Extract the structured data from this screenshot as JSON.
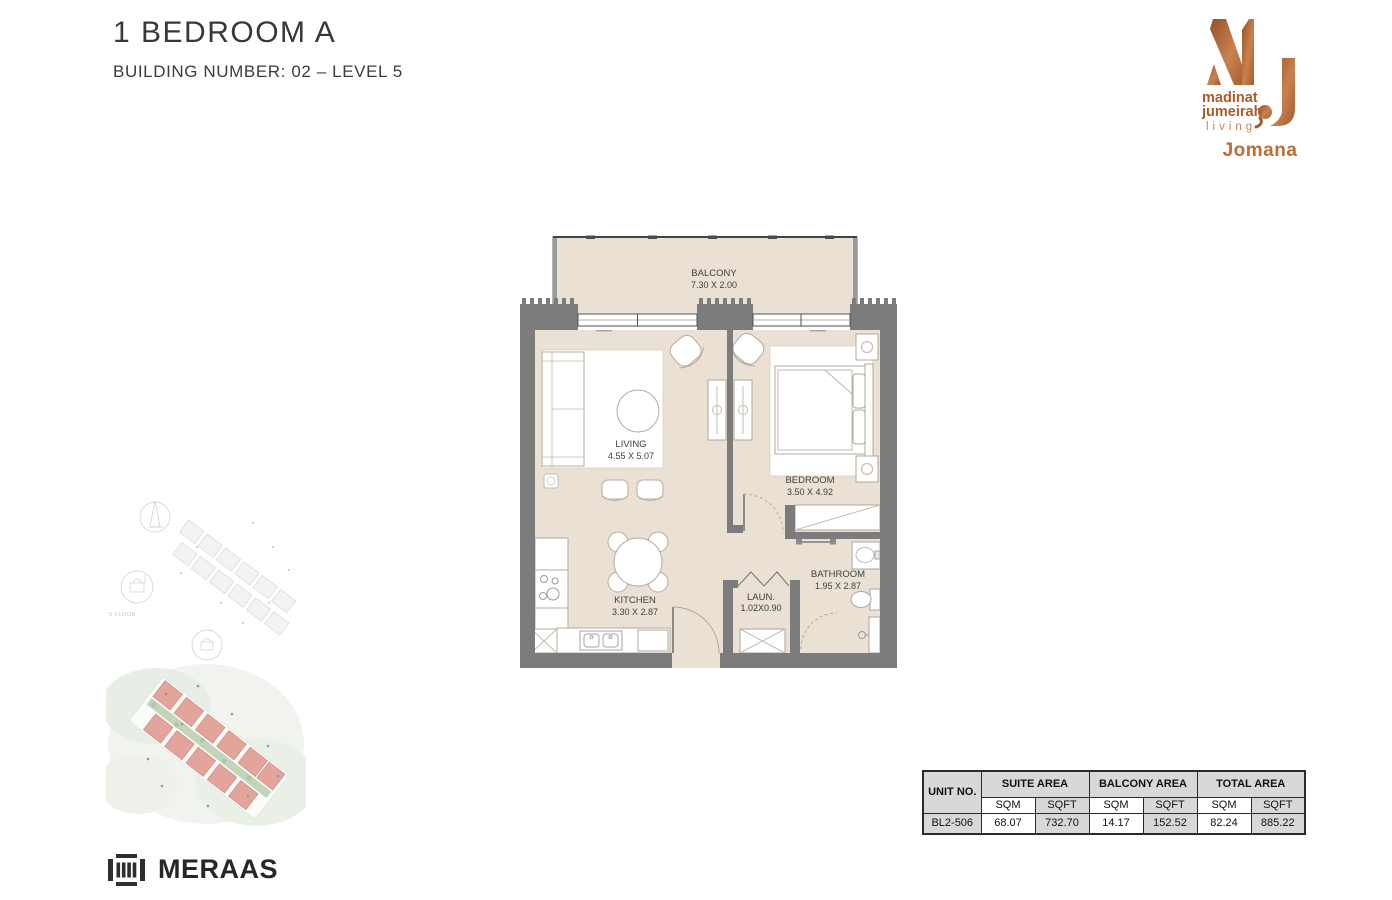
{
  "header": {
    "title": "1 BEDROOM A",
    "subtitle": "BUILDING NUMBER: 02 – LEVEL 5"
  },
  "brand": {
    "monogram": "MJ",
    "line1": "madinat",
    "line2": "jumeirah",
    "line3": "living",
    "project": "Jomana",
    "copper_dark": "#94502A",
    "copper_light": "#C9824E"
  },
  "floorplan": {
    "rooms": [
      {
        "name": "BALCONY",
        "dims": "7.30 X 2.00"
      },
      {
        "name": "LIVING",
        "dims": "4.55 X 5.07"
      },
      {
        "name": "BEDROOM",
        "dims": "3.50 X 4.92"
      },
      {
        "name": "KITCHEN",
        "dims": "3.30 X 2.87"
      },
      {
        "name": "BATHROOM",
        "dims": "1.95 X 2.87"
      },
      {
        "name": "LAUN.",
        "dims": "1.02X0.90"
      }
    ],
    "colors": {
      "floor": "#EAE1D4",
      "wall": "#7C7C7C"
    }
  },
  "site": {
    "note": "5 FLOOR"
  },
  "footer": {
    "logo_text": "MERAAS"
  },
  "area_table": {
    "col_unit": "UNIT NO.",
    "group_suite": "SUITE AREA",
    "group_balcony": "BALCONY AREA",
    "group_total": "TOTAL AREA",
    "sqm": "SQM",
    "sqft": "SQFT",
    "row": {
      "unit": "BL2-506",
      "suite_sqm": "68.07",
      "suite_sqft": "732.70",
      "balcony_sqm": "14.17",
      "balcony_sqft": "152.52",
      "total_sqm": "82.24",
      "total_sqft": "885.22"
    }
  }
}
